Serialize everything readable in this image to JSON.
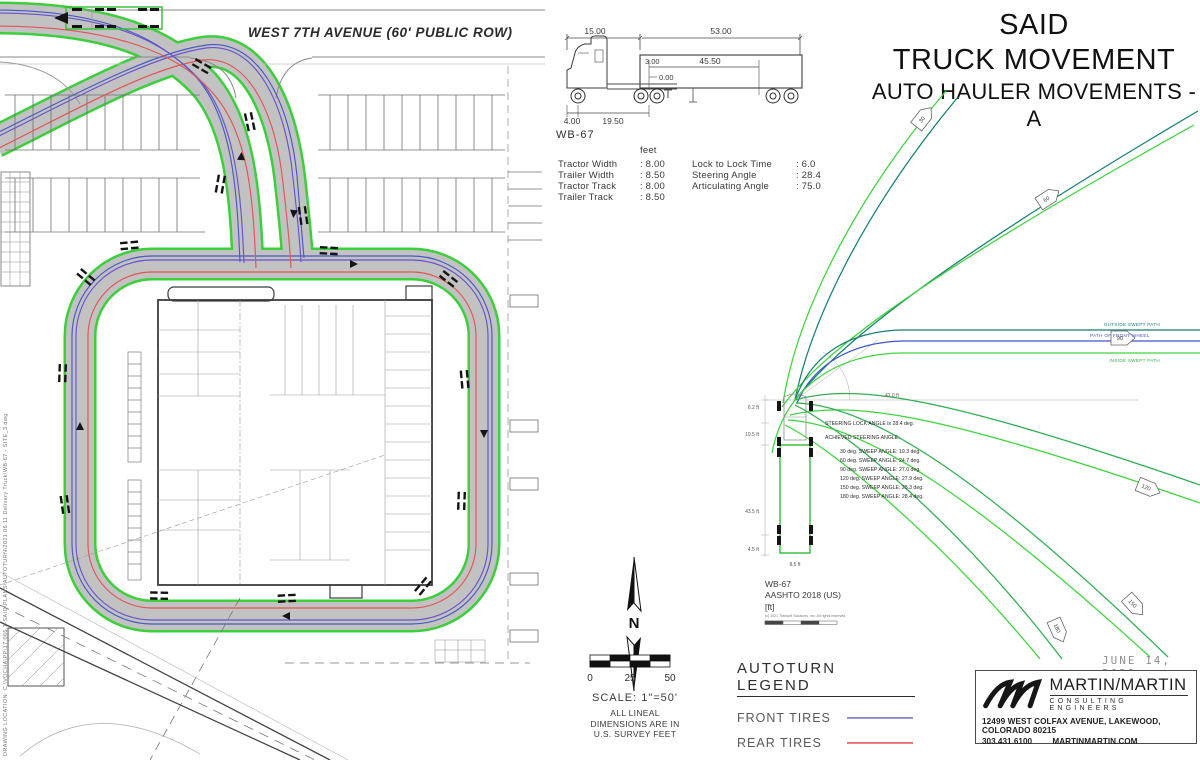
{
  "meta": {
    "drawing_location": "DRAWING LOCATION:  C:\\VOCHA\\PP\\17.066.1-SAID\\PLANS\\AUTOTURN\\2021.06.11 Delivery Truck\\WB-67 - SITE_3.dwg"
  },
  "site_plan": {
    "street_label": "WEST 7TH AVENUE (60' PUBLIC ROW)"
  },
  "title_block": {
    "line1": "SAID",
    "line2": "TRUCK MOVEMENT",
    "line3": "AUTO HAULER MOVEMENTS - A"
  },
  "vehicle_profile": {
    "name": "WB-67",
    "units_header": "feet",
    "dims": {
      "tractor_length": "15.00",
      "trailer_length": "53.00",
      "hitch_offset": "3.00",
      "kingpin_to_tandem": "45.50",
      "articulation_zero": "0.00",
      "front_overhang": "4.00",
      "tractor_wheelbase": "19.50"
    },
    "specs_left": [
      {
        "label": "Tractor Width",
        "value": ": 8.00"
      },
      {
        "label": "Trailer Width",
        "value": ": 8.50"
      },
      {
        "label": "Tractor Track",
        "value": ": 8.00"
      },
      {
        "label": "Trailer Track",
        "value": ": 8.50"
      }
    ],
    "specs_right": [
      {
        "label": "Lock to Lock Time",
        "value": ": 6.0"
      },
      {
        "label": "Steering Angle",
        "value": ": 28.4"
      },
      {
        "label": "Articulating Angle",
        "value": ": 75.0"
      }
    ]
  },
  "north_scale": {
    "north_label": "N",
    "scale_ticks": [
      "0",
      "25",
      "50"
    ],
    "scale_text": "SCALE: 1\"=50'",
    "note_lines": [
      "ALL LINEAL",
      "DIMENSIONS ARE IN",
      "U.S. SURVEY FEET"
    ]
  },
  "legend": {
    "title": "AUTOTURN LEGEND",
    "items": [
      {
        "name": "front-tires",
        "label": "FRONT TIRES",
        "color": "#8585cf"
      },
      {
        "name": "rear-tires",
        "label": "REAR TIRES",
        "color": "#e56a6a"
      },
      {
        "name": "vehicle-body",
        "label": "VEHICLE BODY",
        "color": "#63e063"
      }
    ]
  },
  "template_diagram": {
    "vehicle": "WB-67",
    "standard": "AASHTO 2018 (US)",
    "units": "[ft]",
    "attribution": "(c) 2021 Transoft Solutions, Inc. All rights reserved.",
    "steering_lock_note": "STEERING LOCK ANGLE is 28.4 deg.",
    "achieved_heading": "ACHIEVED STEERING ANGLE:",
    "sweep_table": [
      "30 deg. SWEEP ANGLE: 19.3 deg.",
      "60 deg. SWEEP ANGLE: 24.7 deg.",
      "90 deg. SWEEP ANGLE: 27.0 deg.",
      "120 deg. SWEEP ANGLE: 27.9 deg.",
      "150 deg. SWEEP ANGLE: 28.3 deg.",
      "180 deg. SWEEP ANGLE: 28.4 deg."
    ],
    "path_labels": {
      "outside": "OUTSIDE SWEPT PATH",
      "front_wheel": "PATH OF FRONT WHEEL",
      "inside": "INSIDE SWEPT PATH"
    },
    "angle_markers": [
      "30",
      "60",
      "90",
      "120",
      "150",
      "180"
    ],
    "dim_labels": {
      "d1": "6.2 ft",
      "d2": "19.5 ft",
      "d3": "43.5 ft",
      "d4": "4.5 ft",
      "d5": "8.5 ft",
      "d6": "41.0 ft"
    }
  },
  "date_label": "JUNE 14, 2021",
  "firm_block": {
    "name": "MARTIN/MARTIN",
    "tagline": "CONSULTING ENGINEERS",
    "address": "12499 WEST COLFAX AVENUE,   LAKEWOOD, COLORADO 80215",
    "phone": "303.431.6100",
    "website": "MARTINMARTIN.COM"
  }
}
